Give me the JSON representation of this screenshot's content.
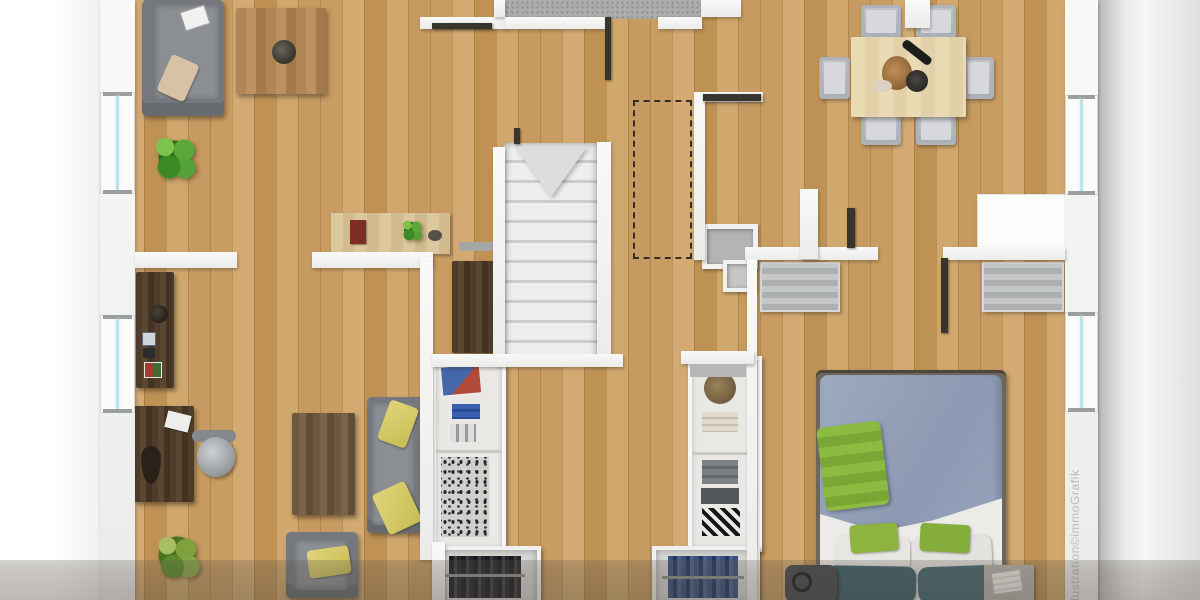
{
  "watermark": {
    "text": "Illustration©immoGrafik",
    "orientation": "vertical, reading bottom to top, right edge",
    "color": "#bcbcbc"
  },
  "scene": {
    "type": "3d-top-down-floor-plan",
    "floor_material": "light oak plank, vertical boards",
    "cropped_edges": [
      "top",
      "bottom"
    ],
    "rooms": [
      {
        "id": "living-room",
        "area": "top-left",
        "furniture": [
          "corner-sofa (grey)",
          "beige-throw-pillow",
          "white-remote/frame",
          "coffee-table (oak)",
          "dark-vase",
          "potted-plant (basil)",
          "sideboard (light wood) with red books, plant and bowl"
        ]
      },
      {
        "id": "bathroom",
        "area": "top-center",
        "floor": "grey mosaic tile",
        "note": "cut off by top edge, two open door leaves"
      },
      {
        "id": "hallway-landing",
        "area": "center",
        "furniture": [
          "staircase (stone, winder top)",
          "grey-doormat"
        ],
        "annotations": [
          "dashed roof/void outline on floor"
        ]
      },
      {
        "id": "dining-room",
        "area": "top-right",
        "furniture": [
          "dining-table (light wood)",
          "6 grey dining-chairs",
          "table setting: bread basket, dark bottle, bowl, plate"
        ]
      },
      {
        "id": "kitchen-niche",
        "area": "right-center",
        "furniture": [
          "white counter unit",
          "grey striped cabinet"
        ]
      },
      {
        "id": "home-office",
        "area": "bottom-left",
        "furniture": [
          "dark wall-shelf with frames and decor",
          "dark desk with papers",
          "office swivel chair",
          "grass plant",
          "dark coffee-table",
          "grey sofa with 2 yellow pillows",
          "grey armchair with yellow pillow"
        ]
      },
      {
        "id": "dressing-room",
        "area": "bottom-center",
        "furniture": [
          "dark tall wardrobe",
          "open shelving unit left (poster, blue stack, sneakers, shoe shelves)",
          "open shelving unit right (basket, towels, folded shirts, zigzag blanket)",
          "two open closets with hanging clothes (dark / denim)"
        ]
      },
      {
        "id": "bedroom",
        "area": "bottom-right",
        "furniture": [
          "double bed: blue-grey duvet, green throw, white sheet, 2 white + 2 green + 2 petrol pillows",
          "bedside table with magazine",
          "dark pouf/bag",
          "grey striped wardrobe"
        ]
      }
    ],
    "openings": {
      "windows_left_wall": 2,
      "windows_right_wall": 2,
      "open_door_leaves": 6
    },
    "lighting": "soft top-down, dark translucent shadow band across bottom edge"
  },
  "palette": {
    "floor_oak": "#c99c62",
    "wall": "#f4f4f2",
    "tile_grey": "#adadab",
    "sofa_grey": "#75797d",
    "accent_yellow": "#d8cc66",
    "accent_green": "#86b43c",
    "bed_blue": "#96a3ba",
    "petrol_pillow": "#3c5f6a",
    "window_glass": "#bfe2e8",
    "outside_left": "#ffffff",
    "outside_right": "#e0e0df",
    "shadow_band": "rgba(88,81,72,0.32)"
  }
}
